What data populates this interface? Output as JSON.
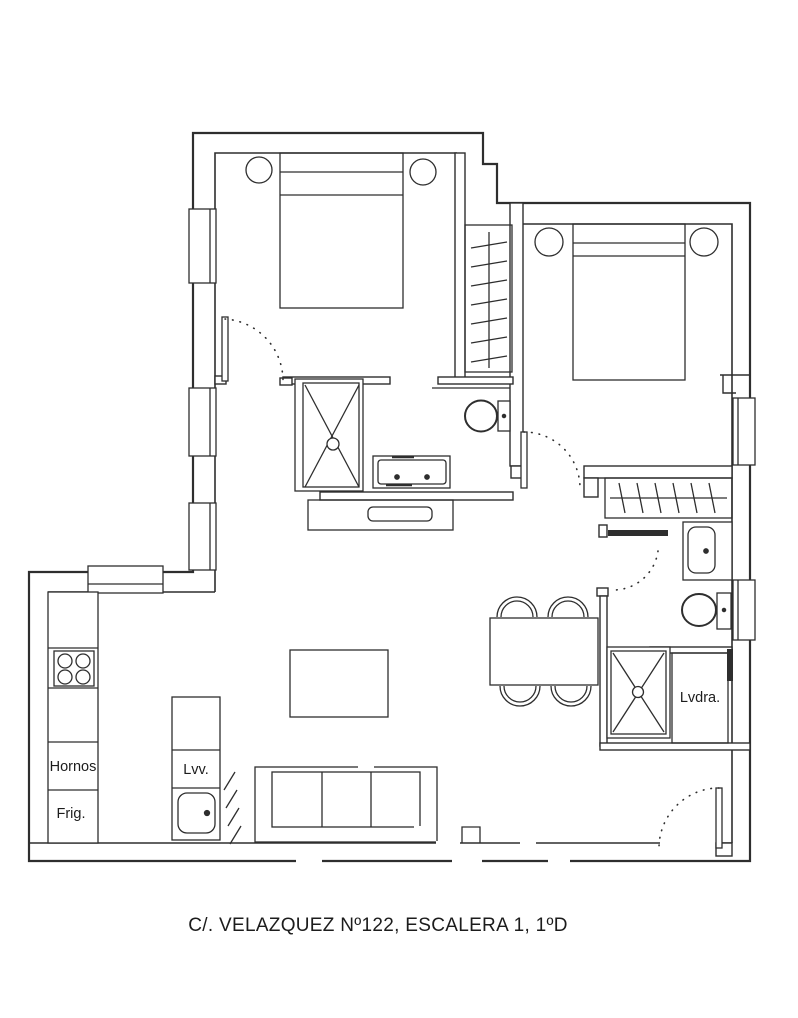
{
  "caption": "C/. VELAZQUEZ Nº122, ESCALERA 1, 1ºD",
  "kitchen": {
    "ovens_label": "Hornos",
    "fridge_label": "Frig.",
    "dishwasher_label": "Lvv."
  },
  "laundry": {
    "label": "Lvdra."
  },
  "colors": {
    "line": "#2e2e2e",
    "text": "#1c1c1c",
    "background": "#ffffff"
  },
  "icons": {
    "bed-icon": "rect-with-headboard-lines",
    "nightstand-icon": "circle",
    "wardrobe-icon": "rect-with-rod-and-hanger-ticks",
    "shower-icon": "rect-with-x-cross-and-drain-circle",
    "toilet-icon": "ellipse-with-cistern-rect",
    "sink-icon": "rounded-rect-with-tap-dot",
    "double-vanity-icon": "rect-with-two-tap-dots",
    "hob-icon": "square-with-four-burner-circles",
    "dining-table-icon": "rect",
    "chair-icon": "double-arc",
    "sofa-icon": "rect-with-three-seat-divisions",
    "coffee-table-icon": "rect",
    "door-swing-icon": "leaf-line-with-dotted-arc",
    "window-icon": "double-line-rect"
  }
}
